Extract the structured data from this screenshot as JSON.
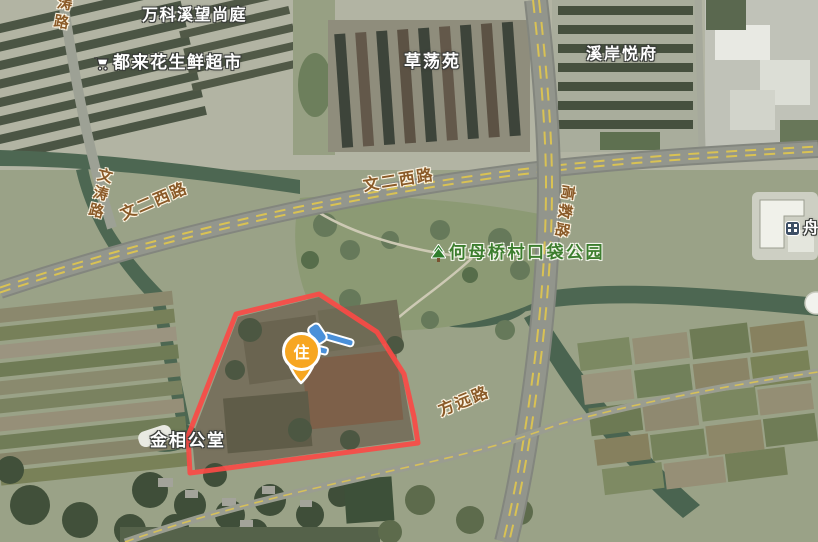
{
  "poi_labels": {
    "vanke": "万科溪望尚庭",
    "supermarket": "都来花生鲜超市",
    "supermarket_icon": "shopping-cart-icon",
    "caodang_yuan": "草荡苑",
    "xian_yuefu": "溪岸悦府",
    "jinxiang_gongtang": "金相公堂",
    "park": "何母桥村口袋公园",
    "park_icon": "tree-icon",
    "building_poi": "舟",
    "building_poi_icon": "building-icon"
  },
  "road_labels": {
    "wen_er_xi_lu": "文二西路",
    "wen_tao_lu": "文涛路",
    "gao_jiao_lu": "高教路",
    "fang_yuan_lu": "方远路"
  },
  "overlay": {
    "parcel_outline_color": "#FA4A45",
    "marker": {
      "label": "住",
      "fill_color": "#F7A621",
      "icon": "auction-gavel-icon",
      "icon_color": "#4A90D9"
    }
  },
  "palette": {
    "poi_text": "#FFFFFF",
    "road_text": "#8A5A28",
    "park_text": "#3C7D2E",
    "water": "#4D6752"
  }
}
